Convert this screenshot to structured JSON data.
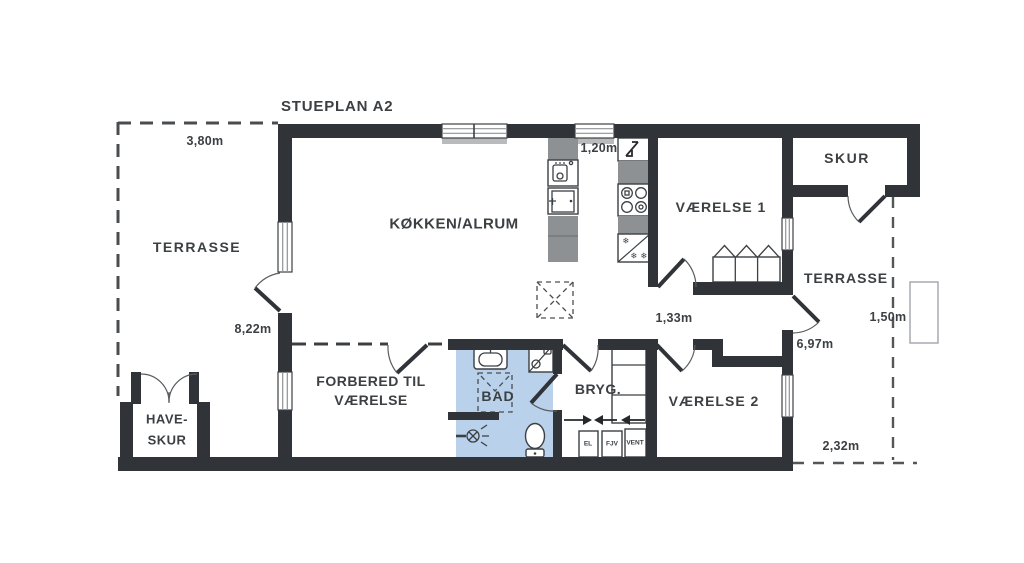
{
  "title": "STUEPLAN A2",
  "labels": {
    "terrasse_left": "TERRASSE",
    "kokken": "KØKKEN/ALRUM",
    "vaerelse1": "VÆRELSE 1",
    "skur": "SKUR",
    "terrasse_right": "TERRASSE",
    "forbered1": "FORBERED TIL",
    "forbered2": "VÆRELSE",
    "bad": "BAD",
    "bryg": "BRYG.",
    "vaerelse2": "VÆRELSE 2",
    "haveskur1": "HAVE-",
    "haveskur2": "SKUR"
  },
  "dimensions": {
    "terrasse_width": "3,80m",
    "window_width": "1,20m",
    "house_length": "8,22m",
    "opening_width": "1,33m",
    "wall_length": "6,97m",
    "step_width": "1,50m",
    "terrasse_depth": "2,32m"
  },
  "utility": {
    "el": "EL",
    "fjv": "FJV",
    "vent": "VENT"
  },
  "icons": {
    "snowflake": "❄"
  },
  "colors": {
    "wall": "#303338",
    "stroke": "#3c4043",
    "text": "#3c4043",
    "counter": "#8e9194",
    "bath": "#b9d1ea",
    "dashed": "#4a4d50"
  }
}
